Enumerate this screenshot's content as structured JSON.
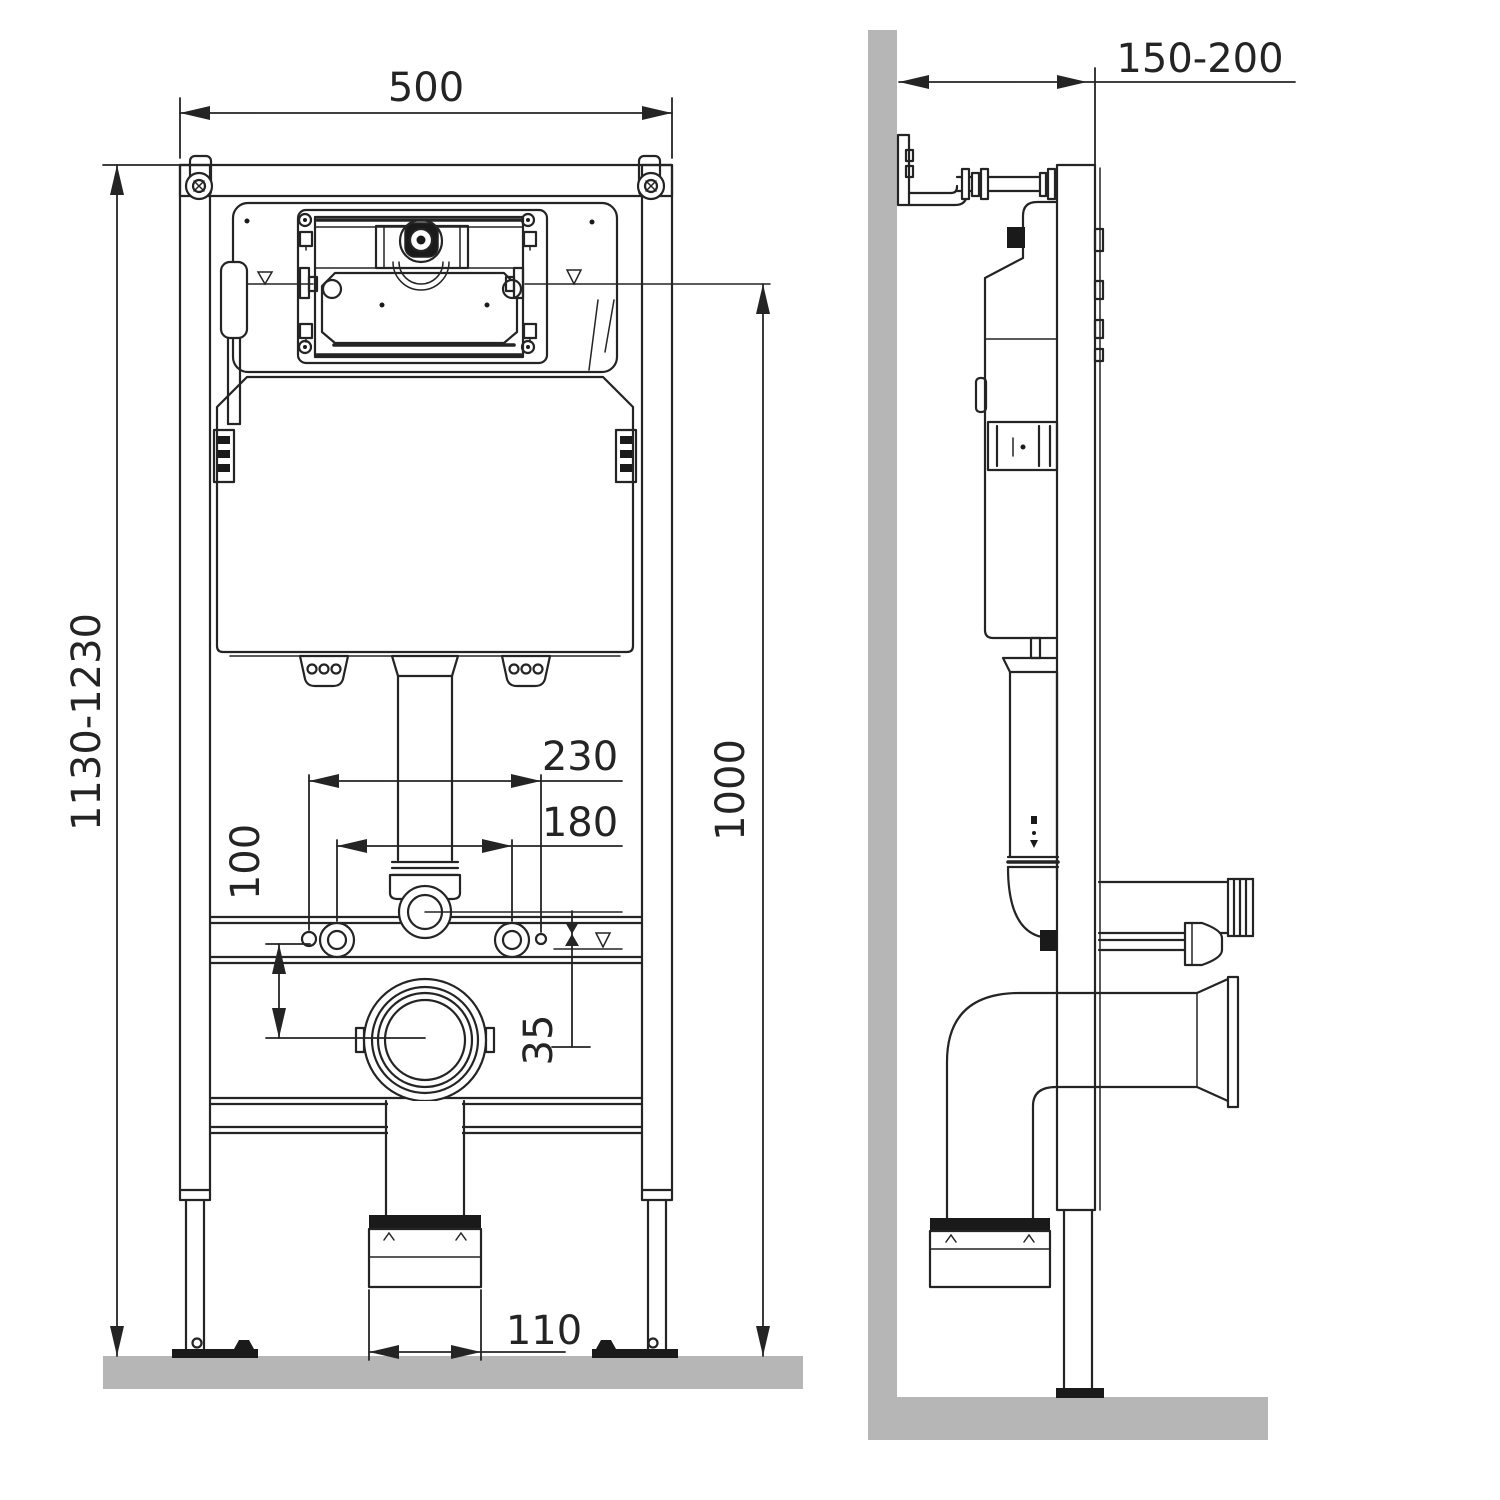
{
  "drawing": {
    "kind": "wall-hung toilet concealed frame installation drawing",
    "views": [
      "front",
      "side"
    ]
  },
  "dims": {
    "frame_width": "500",
    "frame_height_range": "1130-1230",
    "flush_center_height": "1000",
    "outer_fixing_spacing": "230",
    "inner_fixing_spacing": "180",
    "drop_to_outlet": "100",
    "rail_offset": "35",
    "outlet_socket": "110",
    "wall_offset_range": "150-200"
  },
  "colors": {
    "line": "#242424",
    "surface": "#b6b6b6",
    "dark_fill": "#1a1a1a",
    "background": "#ffffff"
  }
}
